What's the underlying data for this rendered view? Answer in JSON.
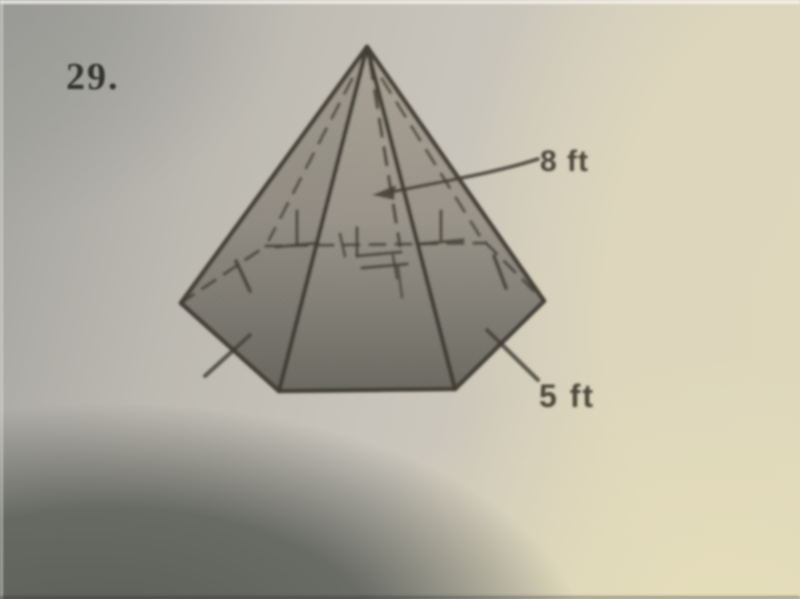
{
  "document": {
    "kind": "textbook-geometry-problem-photo",
    "problem_number": "29.",
    "figure": {
      "shape": "hexagonal-pyramid",
      "height_label": "8 ft",
      "base_edge_label": "5 ft"
    }
  },
  "colors": {
    "ink": "#45423a",
    "number_ink": "#34342f",
    "label_ink": "#4c473b",
    "paper_gray": "#c8c4bb",
    "paper_cream": "#dcd5bc",
    "shadow_gray": "#5c5f59",
    "pyramid_fill_top": "#a9a295",
    "pyramid_fill_bottom": "#6b6a62"
  }
}
